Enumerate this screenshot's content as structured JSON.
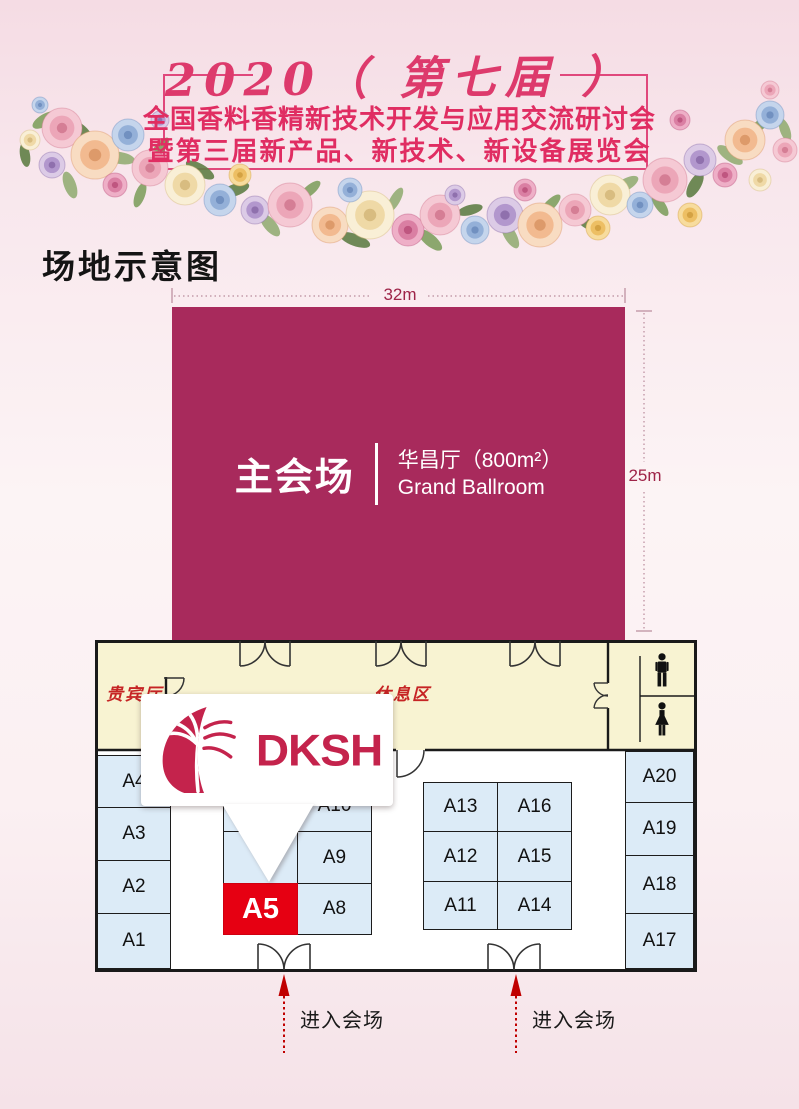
{
  "colors": {
    "hall_magenta": "#a82a5c",
    "title_red": "#e02d62",
    "booth_fill": "#dcebf7",
    "booth_highlight_red": "#e60012",
    "corridor_cream": "#f8f3d2",
    "brand_red": "#c4234c",
    "arrow_red": "#c00000",
    "dimension_red": "#9e2448"
  },
  "header": {
    "edition_line": "2020（ 第七届 ）",
    "title_line1": "全国香料香精新技术开发与应用交流研讨会",
    "title_line2": "暨第三届新产品、新技术、新设备展览会"
  },
  "section_title": "场地示意图",
  "hall": {
    "name": "主会场",
    "room_cn": "华昌厅（800m²）",
    "room_en": "Grand Ballroom",
    "width_dim": "32m",
    "depth_dim": "25m"
  },
  "plan": {
    "vip_room_label": "贵宾厅",
    "rest_area_label": "休息区",
    "entrance_label": "进入会场",
    "callout_brand": "DKSH",
    "highlighted_booth": "A5",
    "icons": [
      "male-restroom-icon",
      "female-restroom-icon"
    ],
    "booths": {
      "a1": "A1",
      "a2": "A2",
      "a3": "A3",
      "a4": "A4",
      "a5": "A5",
      "a8": "A8",
      "a9": "A9",
      "a10": "A10",
      "a11": "A11",
      "a12": "A12",
      "a13": "A13",
      "a14": "A14",
      "a15": "A15",
      "a16": "A16",
      "a17": "A17",
      "a18": "A18",
      "a19": "A19",
      "a20": "A20"
    }
  }
}
